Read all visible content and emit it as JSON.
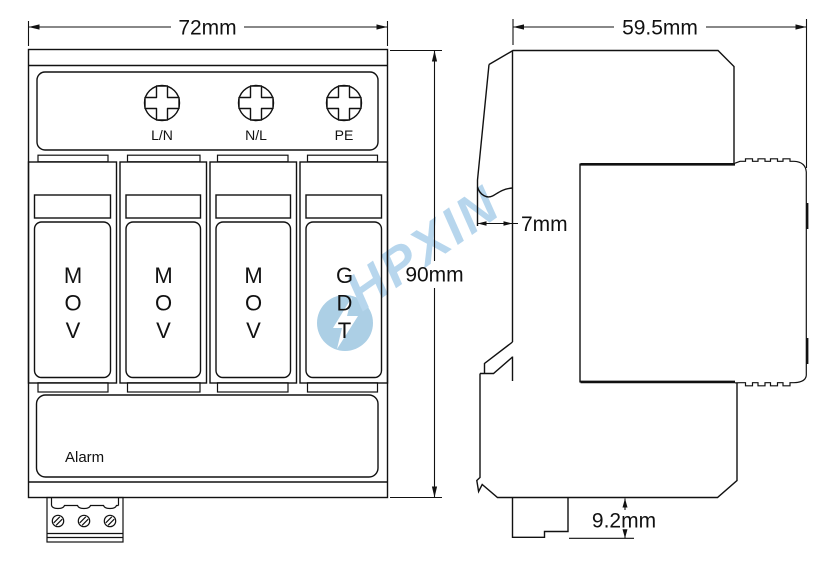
{
  "watermark": {
    "text": "HPXIN"
  },
  "front_view": {
    "width_dim": "72mm",
    "height_dim": "90mm",
    "terminal_labels": [
      "L/N",
      "N/L",
      "PE"
    ],
    "modules": [
      {
        "label": "MOV"
      },
      {
        "label": "MOV"
      },
      {
        "label": "MOV"
      },
      {
        "label": "GDT"
      }
    ],
    "alarm_label": "Alarm"
  },
  "side_view": {
    "width_dim": "59.5mm",
    "lip_dim": "7mm",
    "foot_dim": "9.2mm"
  },
  "colors": {
    "line": "#111111",
    "watermark_circle": "#85b8d9",
    "watermark_text": "#a6cde9"
  }
}
